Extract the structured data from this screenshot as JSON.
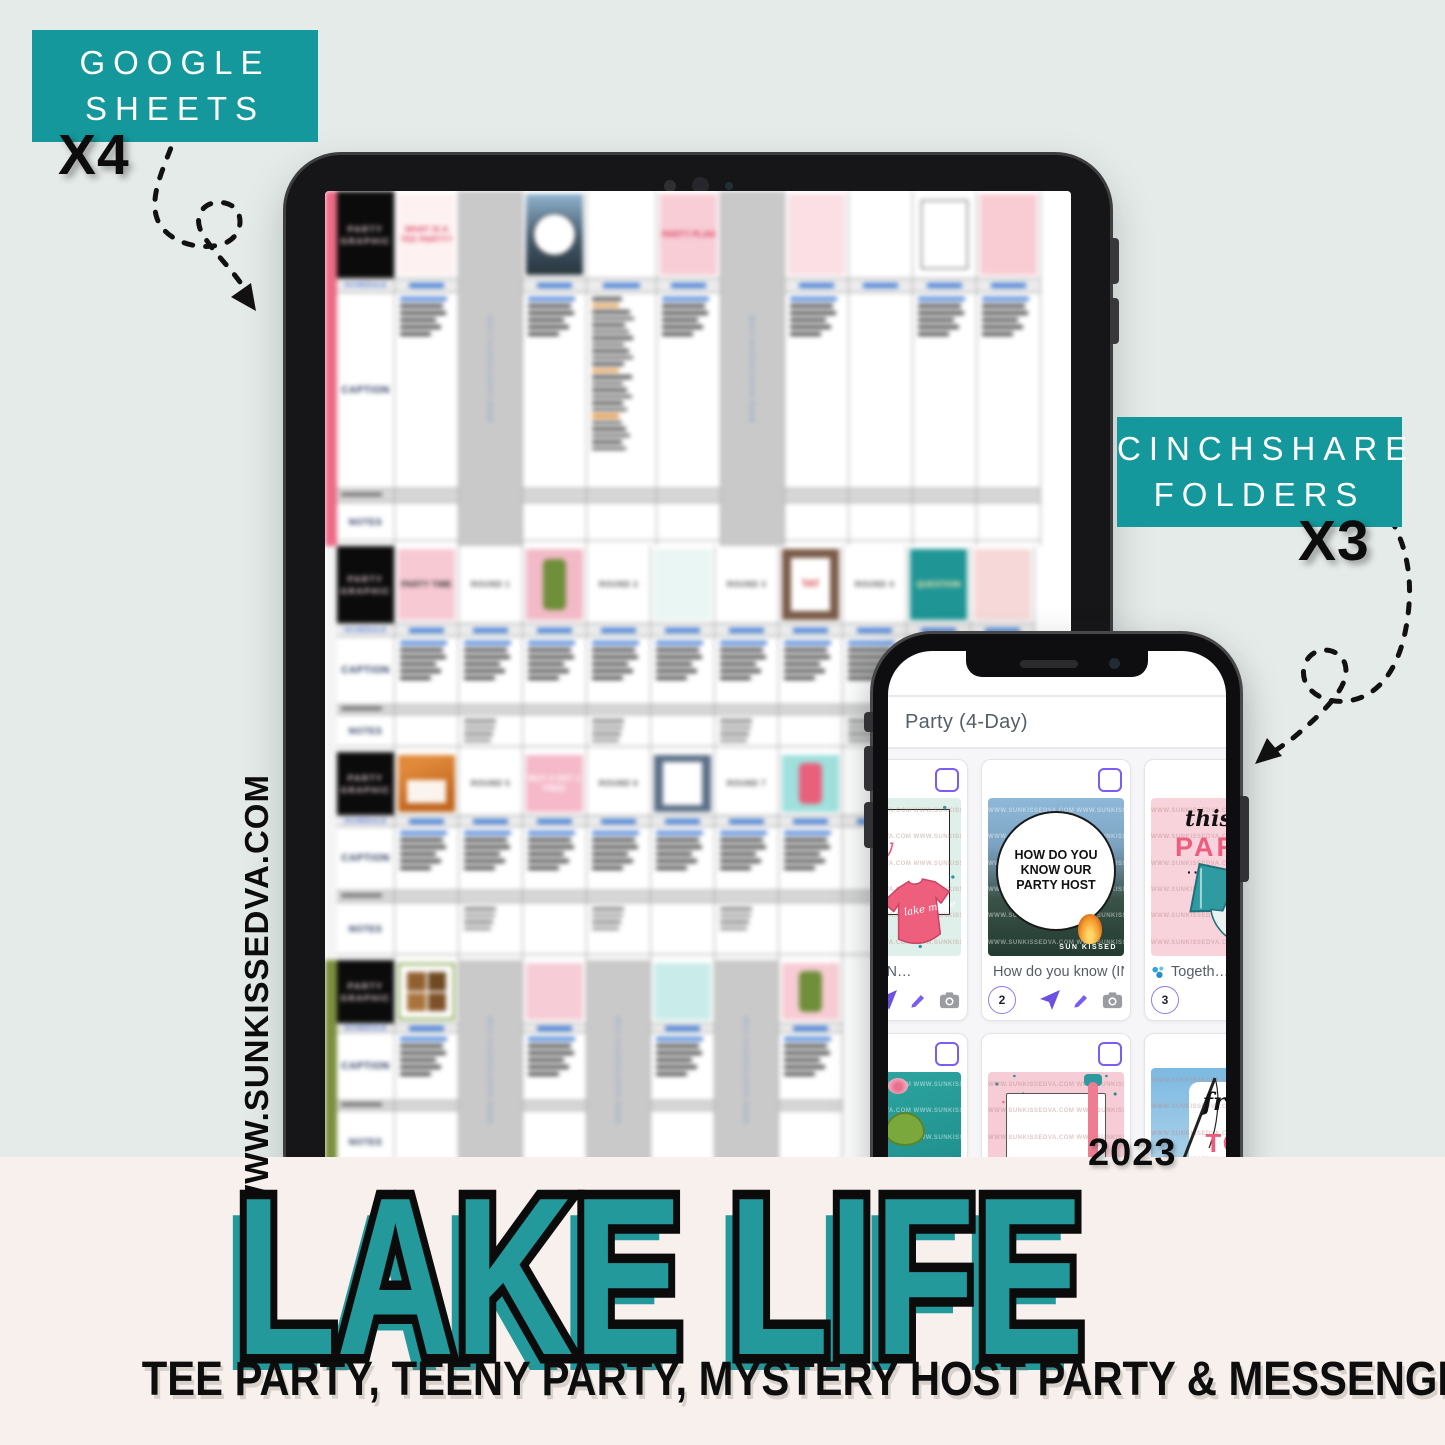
{
  "badges": {
    "google_sheets": {
      "line1": "GOOGLE",
      "line2": "SHEETS",
      "count": "X4",
      "bg": "#14989b"
    },
    "cinchshare": {
      "line1": "CINCHSHARE",
      "line2": "FOLDERS",
      "count": "X3",
      "bg": "#14989b"
    }
  },
  "watermark": "WWW.SUNKISSEDVA.COM",
  "year": "2023",
  "title": {
    "text": "LAKE LIFE",
    "fill": "#23999c",
    "outline": "#0b0b0b"
  },
  "subtitle": "TEE PARTY, TEENY PARTY, MYSTERY HOST PARTY & MESSENGER PARTY",
  "phone": {
    "header": "Party (4-Day)",
    "cards": [
      {
        "caption": "(INSERT N…",
        "image": {
          "frag_isa": "IS A",
          "frag_arty": "arty",
          "frag_lines": "S A AY R MES S!",
          "shirt_text": "lake made"
        }
      },
      {
        "caption": "How do you know (IN…",
        "number": "2",
        "image": {
          "circle_text": "HOW DO YOU KNOW OUR PARTY HOST",
          "brand": "SUN KISSED"
        }
      },
      {
        "caption": "Togeth…",
        "number": "3",
        "image": {
          "script": "this",
          "word": "PART",
          "dots": "···"
        }
      },
      {
        "image": {
          "word": "UP"
        }
      },
      {
        "image": {}
      },
      {
        "image": {
          "script": "fre",
          "word": "TO"
        }
      }
    ]
  },
  "tablet": {
    "sheet": {
      "graphic_label": "PARTY GRAPHIC",
      "row_labels": {
        "schedule": "SCHEDULE",
        "caption": "CAPTION",
        "notes": "NOTES"
      },
      "watermark_small": "WWW.SUNKISSEDVA.COM",
      "sections": [
        {
          "stripe": "#ee6a86",
          "heights": [
            88,
            14,
            196,
            14,
            38
          ],
          "columns": [
            {
              "type": "thumb",
              "kind": "label",
              "bg": "#fdf2f1",
              "label": "WHAT IS A TEE PARTY?",
              "lc": "#e0506b"
            },
            {
              "type": "gray"
            },
            {
              "type": "thumb",
              "kind": "circle"
            },
            {
              "type": "list",
              "w": 70
            },
            {
              "type": "thumb",
              "kind": "label",
              "bg": "#f8cdd6",
              "label": "PARTY PLAN",
              "lc": "#d8445f"
            },
            {
              "type": "gray"
            },
            {
              "type": "thumb",
              "kind": "label",
              "bg": "#fbdfe4",
              "lc": "#d8445f"
            },
            {
              "type": "plain"
            },
            {
              "type": "thumb",
              "kind": "frame",
              "bg": "#ffffff"
            },
            {
              "type": "thumb",
              "kind": "label",
              "bg": "#f9ccd4",
              "lc": "#c03a4a"
            }
          ]
        },
        {
          "stripe": "transparent",
          "heights": [
            78,
            13,
            68,
            10,
            32
          ],
          "columns": [
            {
              "type": "thumb",
              "kind": "label",
              "bg": "#f7c9d3",
              "label": "PARTY TIME",
              "lc": "#333333"
            },
            {
              "type": "round",
              "label": "ROUND 1",
              "notes": true
            },
            {
              "type": "thumb",
              "kind": "can",
              "bg": "#f2bac7",
              "can": "#6f8f3a"
            },
            {
              "type": "round",
              "label": "ROUND 2",
              "notes": true
            },
            {
              "type": "thumb",
              "kind": "label",
              "bg": "#eaf6f3",
              "lc": "#d8445f"
            },
            {
              "type": "round",
              "label": "ROUND 3",
              "notes": true
            },
            {
              "type": "thumb",
              "kind": "tag",
              "bg": "#7a5a48",
              "label": "TAT",
              "lc": "#d23535"
            },
            {
              "type": "round",
              "label": "ROUND 4",
              "notes": true
            },
            {
              "type": "thumb",
              "kind": "label",
              "bg": "#1f9596",
              "label": "QUESTION",
              "lc": "#ffe9a8"
            },
            {
              "type": "thumb",
              "kind": "label",
              "bg": "#f6d8d8",
              "lc": "#c03a4a"
            }
          ]
        },
        {
          "stripe": "transparent",
          "heights": [
            64,
            11,
            64,
            12,
            52
          ],
          "columns": [
            {
              "type": "thumb",
              "kind": "photo"
            },
            {
              "type": "round",
              "label": "ROUND 5",
              "notes": true
            },
            {
              "type": "thumb",
              "kind": "label",
              "bg": "#f5b9c9",
              "label": "BUY 4 GET 1 FREE",
              "lc": "#ffffff"
            },
            {
              "type": "round",
              "label": "ROUND 6",
              "notes": true
            },
            {
              "type": "thumb",
              "kind": "tag",
              "bg": "#5c6f87",
              "lc": "#333333"
            },
            {
              "type": "round",
              "label": "ROUND 7",
              "notes": true
            },
            {
              "type": "thumb",
              "kind": "can",
              "bg": "#9fe0dd",
              "can": "#e8607a"
            },
            {
              "type": "plain"
            },
            {
              "type": "plain"
            },
            {
              "type": "plain"
            }
          ]
        },
        {
          "stripe": "#7c8f3e",
          "heights": [
            64,
            9,
            68,
            10,
            62
          ],
          "columns": [
            {
              "type": "thumb",
              "kind": "smores",
              "bg": "#ffffff"
            },
            {
              "type": "gray"
            },
            {
              "type": "thumb",
              "kind": "label",
              "bg": "#f6ccd6",
              "lc": "#444444"
            },
            {
              "type": "gray"
            },
            {
              "type": "thumb",
              "kind": "label",
              "bg": "#c9ecea",
              "lc": "#d8445f"
            },
            {
              "type": "gray"
            },
            {
              "type": "thumb",
              "kind": "can",
              "bg": "#f7ccd4",
              "can": "#6f8f3a"
            }
          ]
        }
      ]
    }
  }
}
